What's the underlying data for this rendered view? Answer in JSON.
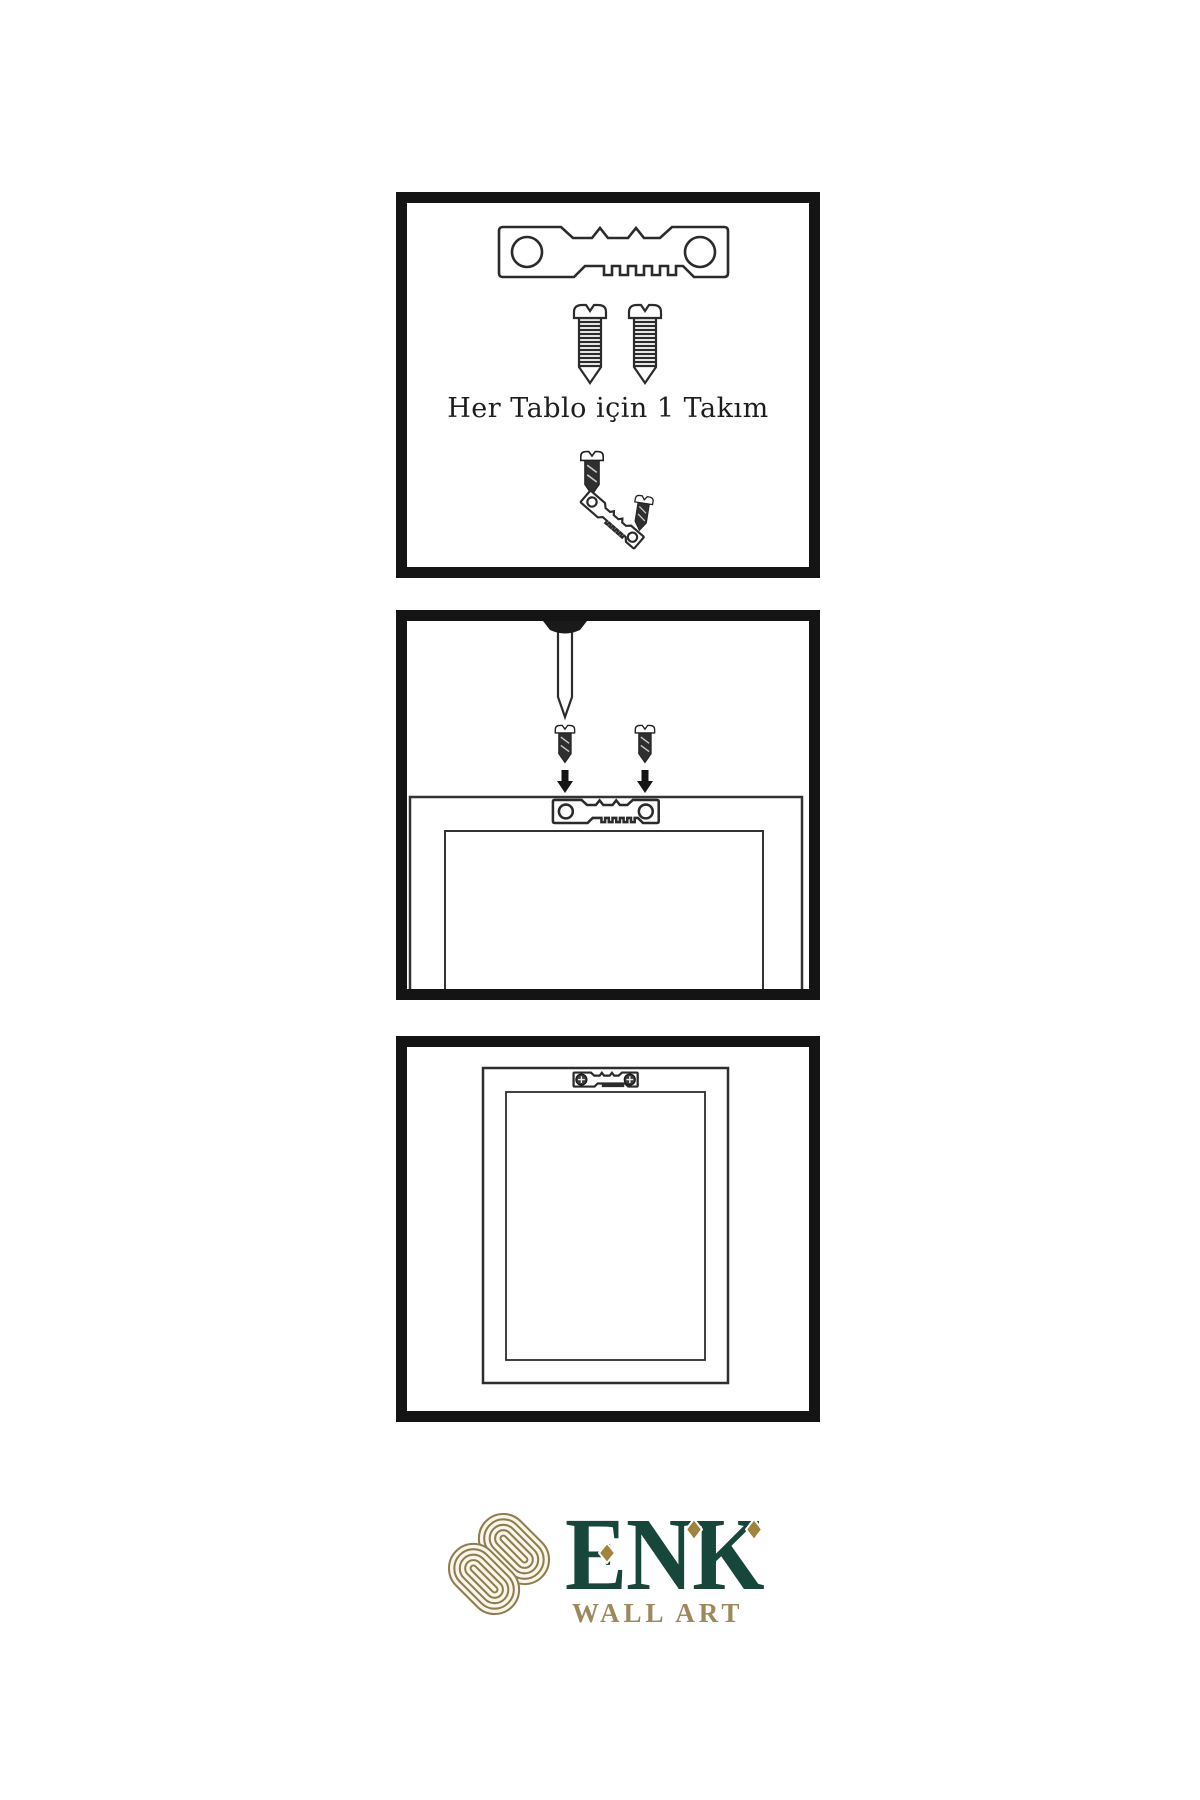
{
  "page": {
    "background": "#ffffff",
    "language": "tr"
  },
  "panel1": {
    "caption": "Her Tablo için 1 Takım"
  },
  "logo": {
    "brand": "ENK",
    "subtitle": "WALL ART"
  },
  "colors": {
    "panel_border": "#141414",
    "line_art": "#2b2b2b",
    "dark_fill": "#2f2f2f",
    "brand_green": "#17463a",
    "brand_gold": "#9c8a5d",
    "diamond_gold": "#a1843c",
    "knot_gold": "#8c7e52",
    "knot_fill": "#fbf6e8",
    "background": "#ffffff"
  },
  "icons": {
    "sawtooth-hanger-icon": "metal sawtooth picture hanger bar with two screw holes",
    "screw-icon": "threaded screw with slotted dome head",
    "dark-screw-icon": "small dark screw with slotted head",
    "nail-icon": "nail driven into wall from above",
    "arrow-down-icon": "solid black downward arrow",
    "phillips-screw-icon": "installed phillips screw head",
    "frame-back-icon": "back of picture frame with stretcher bars",
    "hung-frame-icon": "picture frame hanging on wall",
    "knot-logo-icon": "interlaced gold knot brand mark",
    "diamond-accent-icon": "gold rhombus accent"
  }
}
